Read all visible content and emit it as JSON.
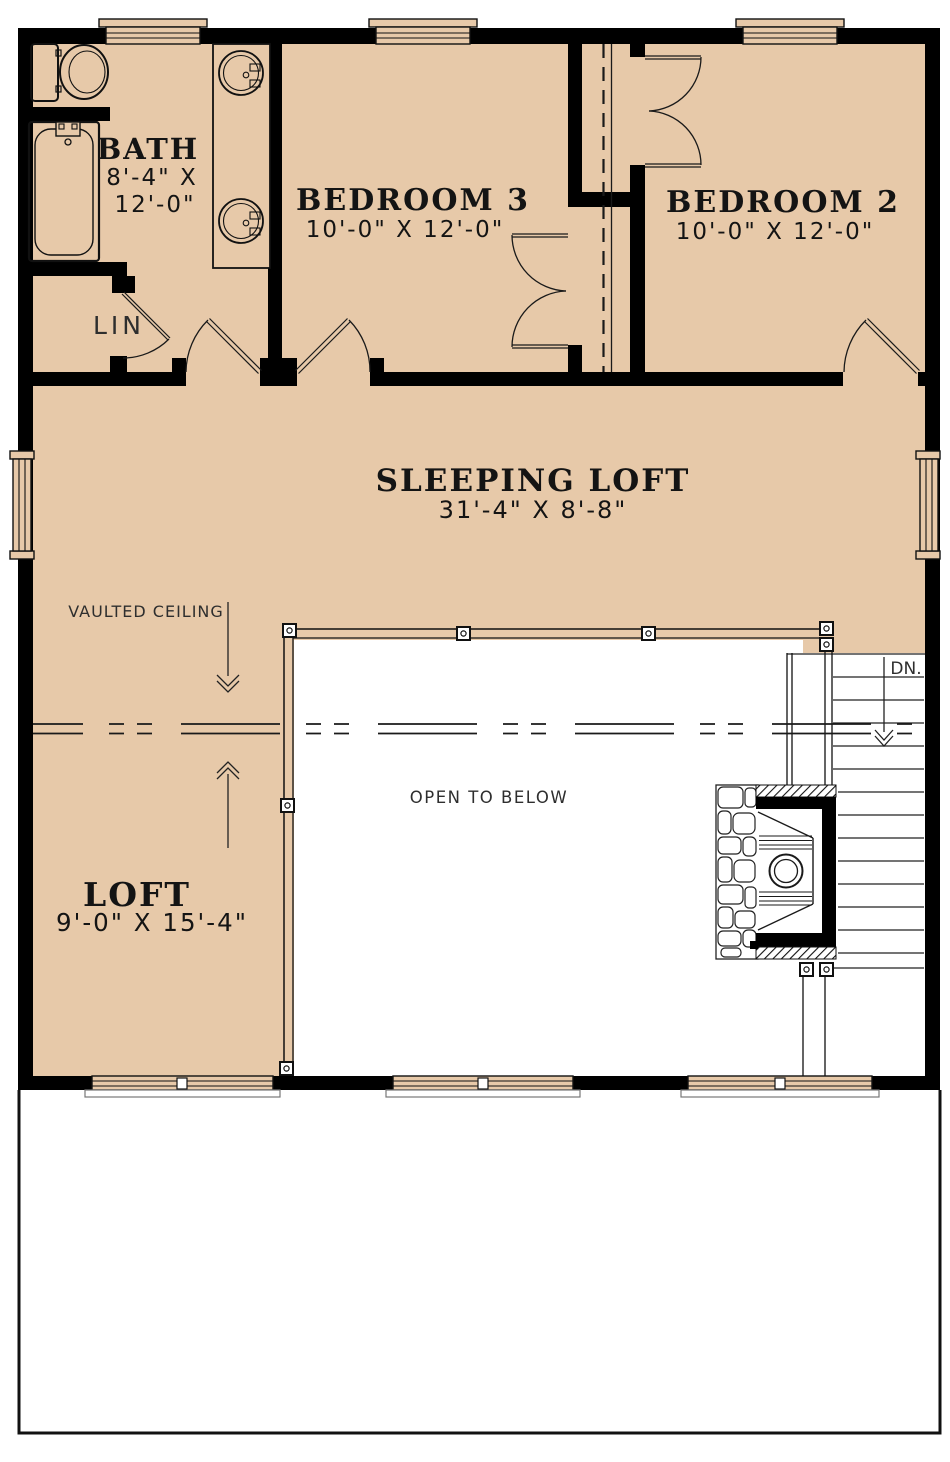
{
  "colors": {
    "floor_tan": "#e7c9a9",
    "wall_black": "#000000",
    "background": "#ffffff",
    "line_dark": "#1a1a1a"
  },
  "rooms": {
    "bath": {
      "name": "BATH",
      "dim_line1": "8'-4\" X",
      "dim_line2": "12'-0\""
    },
    "bedroom3": {
      "name": "BEDROOM 3",
      "dims": "10'-0\" X 12'-0\""
    },
    "bedroom2": {
      "name": "BEDROOM 2",
      "dims": "10'-0\" X 12'-0\""
    },
    "sleeping_loft": {
      "name": "SLEEPING LOFT",
      "dims": "31'-4\" X 8'-8\""
    },
    "loft": {
      "name": "LOFT",
      "dims": "9'-0\" X 15'-4\""
    }
  },
  "annotations": {
    "linen_closet": "LIN",
    "vaulted_ceiling": "VAULTED CEILING",
    "open_to_below": "OPEN TO BELOW",
    "stairs_down": "DN."
  }
}
